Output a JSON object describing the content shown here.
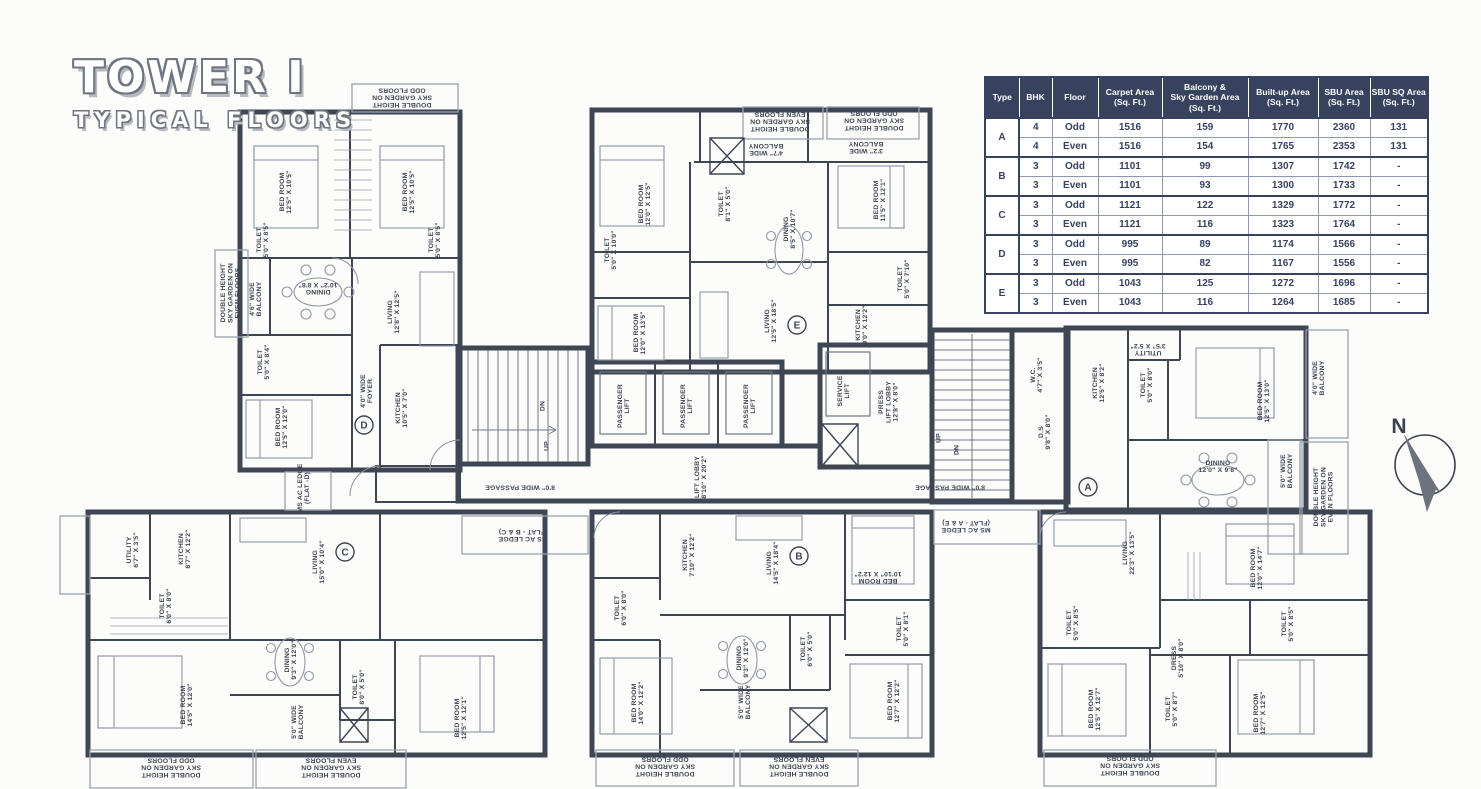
{
  "title": {
    "line1": "TOWER I",
    "line2": "TYPICAL FLOORS"
  },
  "compass": {
    "north_label": "N"
  },
  "colors": {
    "wall": "#3e4553",
    "light_line": "#9aa2ae",
    "furniture": "#9098a6",
    "table_header_bg": "#36425e",
    "table_text": "#36425e",
    "paper": "#fcfcfa"
  },
  "table": {
    "headers": [
      "Type",
      "BHK",
      "Floor",
      "Carpet Area\n(Sq. Ft.)",
      "Balcony &\nSky Garden Area\n(Sq. Ft.)",
      "Built-up Area\n(Sq. Ft.)",
      "SBU Area\n(Sq. Ft.)",
      "SBU SQ Area\n(Sq. Ft.)"
    ],
    "groups": [
      {
        "type": "A",
        "rows": [
          [
            "4",
            "Odd",
            "1516",
            "159",
            "1770",
            "2360",
            "131"
          ],
          [
            "4",
            "Even",
            "1516",
            "154",
            "1765",
            "2353",
            "131"
          ]
        ]
      },
      {
        "type": "B",
        "rows": [
          [
            "3",
            "Odd",
            "1101",
            "99",
            "1307",
            "1742",
            "-"
          ],
          [
            "3",
            "Even",
            "1101",
            "93",
            "1300",
            "1733",
            "-"
          ]
        ]
      },
      {
        "type": "C",
        "rows": [
          [
            "3",
            "Odd",
            "1121",
            "122",
            "1329",
            "1772",
            "-"
          ],
          [
            "3",
            "Even",
            "1121",
            "116",
            "1323",
            "1764",
            "-"
          ]
        ]
      },
      {
        "type": "D",
        "rows": [
          [
            "3",
            "Odd",
            "995",
            "89",
            "1174",
            "1566",
            "-"
          ],
          [
            "3",
            "Even",
            "995",
            "82",
            "1167",
            "1556",
            "-"
          ]
        ]
      },
      {
        "type": "E",
        "rows": [
          [
            "3",
            "Odd",
            "1043",
            "125",
            "1272",
            "1696",
            "-"
          ],
          [
            "3",
            "Even",
            "1043",
            "116",
            "1264",
            "1685",
            "-"
          ]
        ]
      }
    ]
  },
  "plan": {
    "units": [
      {
        "letter": "A",
        "x": 1088,
        "y": 487
      },
      {
        "letter": "B",
        "x": 799,
        "y": 556
      },
      {
        "letter": "C",
        "x": 345,
        "y": 552
      },
      {
        "letter": "D",
        "x": 364,
        "y": 425
      },
      {
        "letter": "E",
        "x": 797,
        "y": 325
      }
    ],
    "labels": [
      {
        "l": [
          "BED ROOM",
          "12'5\" X 10'5\""
        ],
        "x": 285,
        "y": 192,
        "r": -90
      },
      {
        "l": [
          "BED ROOM",
          "12'5\" X 10'5\""
        ],
        "x": 408,
        "y": 192,
        "r": -90
      },
      {
        "l": [
          "TOILET",
          "5'0\" X 8'5\""
        ],
        "x": 262,
        "y": 240,
        "r": -90,
        "fs": 6
      },
      {
        "l": [
          "TOILET",
          "5'0\" X 8'5\""
        ],
        "x": 434,
        "y": 240,
        "r": -90,
        "fs": 6
      },
      {
        "l": [
          "DINING",
          "10'2\" X 8'8\""
        ],
        "x": 318,
        "y": 289,
        "r": 180,
        "fs": 6.2
      },
      {
        "l": [
          "4'6\" WIDE",
          "BALCONY"
        ],
        "x": 255,
        "y": 299,
        "r": -90,
        "fs": 6
      },
      {
        "l": [
          "LIVING",
          "12'8\" X 12'5\""
        ],
        "x": 393,
        "y": 312,
        "r": -90
      },
      {
        "l": [
          "DOUBLE HEIGHT",
          "SKY GARDEN ON",
          "EVEN FLOORS"
        ],
        "x": 230,
        "y": 293,
        "r": -90,
        "fs": 5.5
      },
      {
        "l": [
          "TOILET",
          "5'0\" X 8'4\""
        ],
        "x": 263,
        "y": 362,
        "r": -90,
        "fs": 6
      },
      {
        "l": [
          "BED ROOM",
          "12'5\" X 12'0\""
        ],
        "x": 281,
        "y": 427,
        "r": -90
      },
      {
        "l": [
          "4'0\" WIDE",
          "FOYER"
        ],
        "x": 366,
        "y": 391,
        "r": -90,
        "fs": 6
      },
      {
        "l": [
          "KITCHEN",
          "10'5\" X 7'0\""
        ],
        "x": 401,
        "y": 408,
        "r": -90,
        "fs": 6.2
      },
      {
        "l": [
          "MS AC LEDGE",
          "(FLAT -D)"
        ],
        "x": 303,
        "y": 488,
        "r": -90,
        "fs": 5.5
      },
      {
        "l": [
          "DOUBLE HEIGHT",
          "SKY GARDEN ON",
          "ODD FLOORS"
        ],
        "x": 402,
        "y": 98,
        "r": 180,
        "fs": 5.5
      },
      {
        "l": [
          "8'0\" WIDE PASSAGE"
        ],
        "x": 520,
        "y": 488,
        "r": 180,
        "fs": 6.2
      },
      {
        "l": [
          "DN"
        ],
        "x": 542,
        "y": 406,
        "r": -90,
        "fs": 6
      },
      {
        "l": [
          "UP"
        ],
        "x": 546,
        "y": 446,
        "r": -90,
        "fs": 6
      },
      {
        "l": [
          "PASSENGER",
          "LIFT"
        ],
        "x": 623,
        "y": 406,
        "r": -90,
        "fs": 6.2
      },
      {
        "l": [
          "PASSENGER",
          "LIFT"
        ],
        "x": 686,
        "y": 406,
        "r": -90,
        "fs": 6.2
      },
      {
        "l": [
          "PASSENGER",
          "LIFT"
        ],
        "x": 749,
        "y": 406,
        "r": -90,
        "fs": 6.2
      },
      {
        "l": [
          "LIFT LOBBY",
          "8'10\" X 20'2\""
        ],
        "x": 700,
        "y": 477,
        "r": -90,
        "fs": 6.2
      },
      {
        "l": [
          "SERVICE",
          "LIFT"
        ],
        "x": 843,
        "y": 391,
        "r": -90,
        "fs": 6.2
      },
      {
        "l": [
          "PRESS",
          "LIFT LOBBY",
          "12'8\" X 8'0\""
        ],
        "x": 888,
        "y": 402,
        "r": -90,
        "fs": 6
      },
      {
        "l": [
          "UP"
        ],
        "x": 938,
        "y": 438,
        "r": -90,
        "fs": 6
      },
      {
        "l": [
          "DN"
        ],
        "x": 956,
        "y": 450,
        "r": -90,
        "fs": 6
      },
      {
        "l": [
          "W.C.",
          "4'7\" X 3'5\""
        ],
        "x": 1036,
        "y": 375,
        "r": -90,
        "fs": 5.5
      },
      {
        "l": [
          "D.S",
          "9'8\" X 8'0\""
        ],
        "x": 1044,
        "y": 432,
        "r": -90,
        "fs": 6
      },
      {
        "l": [
          "8'0\" WIDE PASSAGE"
        ],
        "x": 950,
        "y": 488,
        "r": 180,
        "fs": 6.2
      },
      {
        "l": [
          "MS AC LEDGE",
          "(FLAT - B & C)"
        ],
        "x": 523,
        "y": 536,
        "r": 180,
        "fs": 5.5
      },
      {
        "l": [
          "MS AC LEDGE",
          "(FLAT - A & E)"
        ],
        "x": 966,
        "y": 527,
        "r": 180,
        "fs": 5.5
      },
      {
        "l": [
          "BED ROOM",
          "12'0\" X 12'5\""
        ],
        "x": 644,
        "y": 204,
        "r": -90
      },
      {
        "l": [
          "TOILET",
          "5'0\" X 10'0\""
        ],
        "x": 610,
        "y": 250,
        "r": -90,
        "fs": 6
      },
      {
        "l": [
          "BED ROOM",
          "12'0\" X 13'5\""
        ],
        "x": 639,
        "y": 333,
        "r": -90
      },
      {
        "l": [
          "TOILET",
          "8'1\" X 5'0\""
        ],
        "x": 724,
        "y": 204,
        "r": -90,
        "fs": 6
      },
      {
        "l": [
          "4'7\" WIDE",
          "BALCONY"
        ],
        "x": 766,
        "y": 150,
        "r": 180,
        "fs": 6
      },
      {
        "l": [
          "3'2\" WIDE",
          "BALCONY"
        ],
        "x": 866,
        "y": 148,
        "r": 180,
        "fs": 6
      },
      {
        "l": [
          "DOUBLE HEIGHT",
          "SKY GARDEN ON",
          "EVEN FLOORS"
        ],
        "x": 780,
        "y": 122,
        "r": 180,
        "fs": 5.2
      },
      {
        "l": [
          "DOUBLE HEIGHT",
          "SKY GARDEN ON",
          "ODD FLOORS"
        ],
        "x": 874,
        "y": 121,
        "r": 180,
        "fs": 5.2
      },
      {
        "l": [
          "DINING",
          "8'5\" X 10'7\""
        ],
        "x": 789,
        "y": 229,
        "r": -90,
        "fs": 6.2
      },
      {
        "l": [
          "BED ROOM",
          "11'5\" X 12'1\""
        ],
        "x": 879,
        "y": 200,
        "r": -90
      },
      {
        "l": [
          "TOILET",
          "5'0\" X 7'10\""
        ],
        "x": 903,
        "y": 279,
        "r": -90,
        "fs": 6
      },
      {
        "l": [
          "KITCHEN",
          "9'0\" X 12'2\""
        ],
        "x": 861,
        "y": 325,
        "r": -90,
        "fs": 6.2
      },
      {
        "l": [
          "LIVING",
          "12'5\" X 18'5\""
        ],
        "x": 770,
        "y": 321,
        "r": -90
      },
      {
        "l": [
          "KITCHEN",
          "12'5\" X 8'2\""
        ],
        "x": 1098,
        "y": 383,
        "r": -90,
        "fs": 6.2
      },
      {
        "l": [
          "UTILITY",
          "3'5\" X 5'2\""
        ],
        "x": 1148,
        "y": 350,
        "r": 180,
        "fs": 5.5
      },
      {
        "l": [
          "TOILET",
          "5'0\" X 8'0\""
        ],
        "x": 1146,
        "y": 385,
        "r": -90,
        "fs": 6
      },
      {
        "l": [
          "BED ROOM",
          "12'5\" X 13'0\""
        ],
        "x": 1263,
        "y": 401,
        "r": -90
      },
      {
        "l": [
          "4'0\" WIDE",
          "BALCONY"
        ],
        "x": 1318,
        "y": 378,
        "r": -90,
        "fs": 6
      },
      {
        "l": [
          "DINING",
          "12'0\" X 9'8\""
        ],
        "x": 1218,
        "y": 466,
        "r": 0,
        "fs": 6.2
      },
      {
        "l": [
          "5'0\" WIDE",
          "BALCONY"
        ],
        "x": 1286,
        "y": 471,
        "r": -90,
        "fs": 6
      },
      {
        "l": [
          "DOUBLE HEIGHT",
          "SKY GARDEN ON",
          "EVEN FLOORS"
        ],
        "x": 1323,
        "y": 497,
        "r": -90,
        "fs": 5.2
      },
      {
        "l": [
          "LIVING",
          "22'3\" X 13'5\""
        ],
        "x": 1128,
        "y": 553,
        "r": -90
      },
      {
        "l": [
          "BED ROOM",
          "12'0\" X 14'7\""
        ],
        "x": 1256,
        "y": 568,
        "r": -90
      },
      {
        "l": [
          "TOILET",
          "5'0\" X 8'5\""
        ],
        "x": 1072,
        "y": 623,
        "r": -90,
        "fs": 6
      },
      {
        "l": [
          "TOILET",
          "5'0\" X 8'5\""
        ],
        "x": 1287,
        "y": 624,
        "r": -90,
        "fs": 6
      },
      {
        "l": [
          "DRESS",
          "5'10\" X 8'0\""
        ],
        "x": 1177,
        "y": 658,
        "r": -90,
        "fs": 6
      },
      {
        "l": [
          "BED ROOM",
          "12'5\" X 12'7\""
        ],
        "x": 1094,
        "y": 709,
        "r": -90
      },
      {
        "l": [
          "TOILET",
          "5'0\" X 8'7\""
        ],
        "x": 1171,
        "y": 709,
        "r": -90,
        "fs": 6
      },
      {
        "l": [
          "BED ROOM",
          "12'7\" X 12'5\""
        ],
        "x": 1259,
        "y": 713,
        "r": -90
      },
      {
        "l": [
          "DOUBLE HEIGHT",
          "SKY GARDEN ON",
          "ODD FLOORS"
        ],
        "x": 1130,
        "y": 766,
        "r": 180,
        "fs": 5.5
      },
      {
        "l": [
          "UTILITY",
          "6'7\" X 3'5\""
        ],
        "x": 132,
        "y": 550,
        "r": -90,
        "fs": 5.5
      },
      {
        "l": [
          "KITCHEN",
          "8'7\" X 12'2\""
        ],
        "x": 184,
        "y": 549,
        "r": -90,
        "fs": 6.2
      },
      {
        "l": [
          "LIVING",
          "15'0\" X 10'4\""
        ],
        "x": 318,
        "y": 562,
        "r": -90
      },
      {
        "l": [
          "TOILET",
          "6'0\" X 8'0\""
        ],
        "x": 165,
        "y": 606,
        "r": -90,
        "fs": 6
      },
      {
        "l": [
          "BED ROOM",
          "14'5\" X 12'0\""
        ],
        "x": 186,
        "y": 705,
        "r": -90
      },
      {
        "l": [
          "DINING",
          "9'3\" X 12'0\""
        ],
        "x": 290,
        "y": 660,
        "r": -90,
        "fs": 6.2
      },
      {
        "l": [
          "TOILET",
          "8'0\" X 5'0\""
        ],
        "x": 358,
        "y": 687,
        "r": -90,
        "fs": 6
      },
      {
        "l": [
          "5'0\" WIDE",
          "BALCONY"
        ],
        "x": 297,
        "y": 722,
        "r": -90,
        "fs": 6
      },
      {
        "l": [
          "BED ROOM",
          "12'5\" X 12'1\""
        ],
        "x": 460,
        "y": 718,
        "r": -90
      },
      {
        "l": [
          "DOUBLE HEIGHT",
          "SKY GARDEN ON",
          "ODD FLOORS"
        ],
        "x": 171,
        "y": 768,
        "r": 180,
        "fs": 5.2
      },
      {
        "l": [
          "DOUBLE HEIGHT",
          "SKY GARDEN ON",
          "EVEN FLOORS"
        ],
        "x": 331,
        "y": 768,
        "r": 180,
        "fs": 5.2
      },
      {
        "l": [
          "KITCHEN",
          "7'10\" X 12'2\""
        ],
        "x": 688,
        "y": 555,
        "r": -90,
        "fs": 6.2
      },
      {
        "l": [
          "LIVING",
          "14'5\" X 18'4\""
        ],
        "x": 772,
        "y": 563,
        "r": -90
      },
      {
        "l": [
          "TOILET",
          "6'0\" X 8'0\""
        ],
        "x": 620,
        "y": 608,
        "r": -90,
        "fs": 6
      },
      {
        "l": [
          "BED ROOM",
          "14'0\" X 12'2\""
        ],
        "x": 637,
        "y": 703,
        "r": -90
      },
      {
        "l": [
          "DINING",
          "9'3\" X 12'0\""
        ],
        "x": 742,
        "y": 658,
        "r": -90,
        "fs": 6.2
      },
      {
        "l": [
          "TOILET",
          "6'0\" X 5'0\""
        ],
        "x": 806,
        "y": 649,
        "r": -90,
        "fs": 6
      },
      {
        "l": [
          "BED ROOM",
          "10'10\" X 12'2\""
        ],
        "x": 878,
        "y": 578,
        "r": 180
      },
      {
        "l": [
          "TOILET",
          "5'0\" X 8'1\""
        ],
        "x": 902,
        "y": 629,
        "r": -90,
        "fs": 6
      },
      {
        "l": [
          "BED ROOM",
          "12'7\" X 12'2\""
        ],
        "x": 893,
        "y": 701,
        "r": -90
      },
      {
        "l": [
          "5'0\" WIDE",
          "BALCONY"
        ],
        "x": 744,
        "y": 702,
        "r": -90,
        "fs": 6
      },
      {
        "l": [
          "DOUBLE HEIGHT",
          "SKY GARDEN ON",
          "ODD FLOORS"
        ],
        "x": 665,
        "y": 767,
        "r": 180,
        "fs": 5.2
      },
      {
        "l": [
          "DOUBLE HEIGHT",
          "SKY GARDEN ON",
          "EVEN FLOORS"
        ],
        "x": 799,
        "y": 767,
        "r": 180,
        "fs": 5.2
      }
    ]
  }
}
